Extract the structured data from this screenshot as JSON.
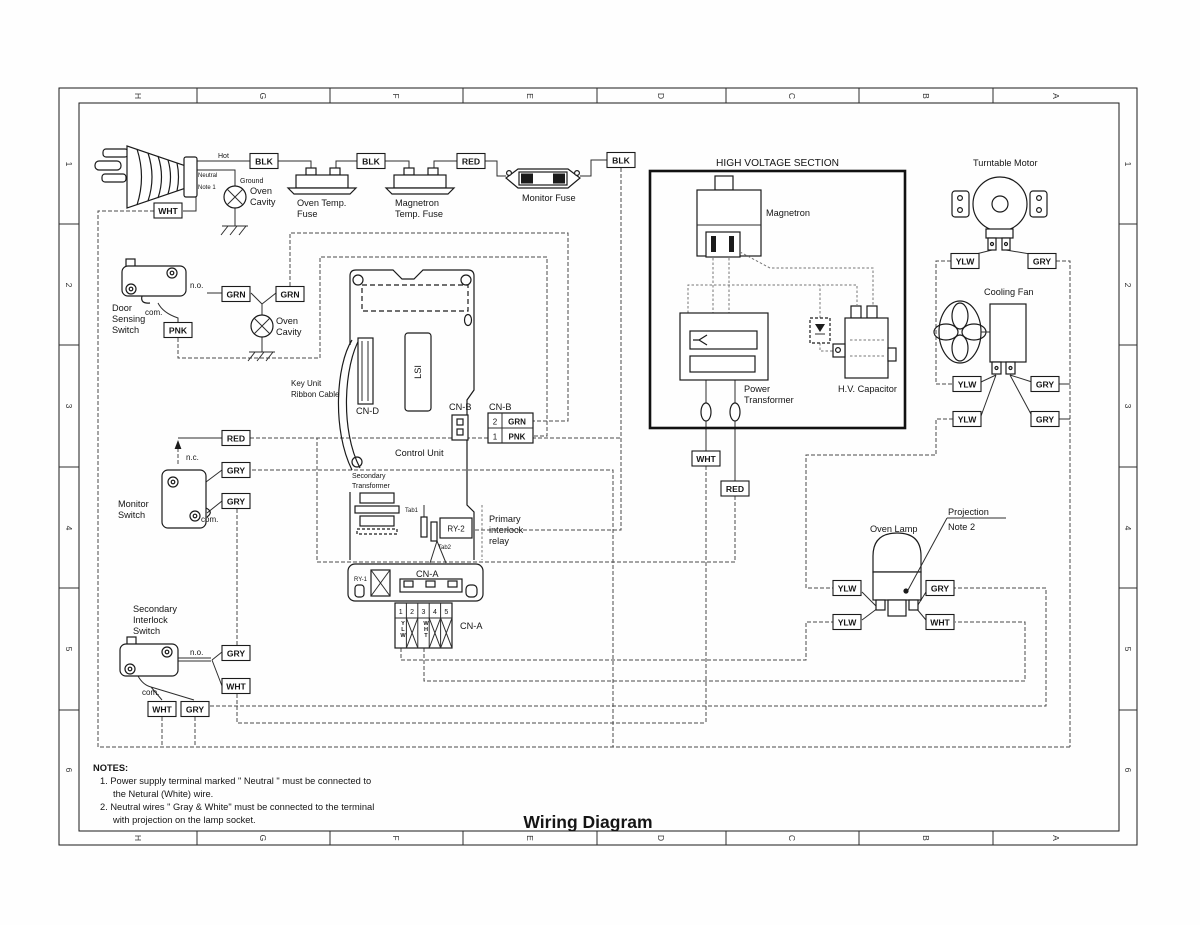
{
  "title": "Wiring Diagram",
  "grid": {
    "cols": [
      "H",
      "G",
      "F",
      "E",
      "D",
      "C",
      "B",
      "A"
    ],
    "rows": [
      "1",
      "2",
      "3",
      "4",
      "5",
      "6"
    ]
  },
  "plug": {
    "hot": "Hot",
    "neutral": "Neutral",
    "note1": "Note 1",
    "ground": "Ground"
  },
  "labels": {
    "oven_cavity_1": "Oven",
    "oven_cavity_2": "Cavity",
    "oven_temp_fuse_1": "Oven Temp.",
    "oven_temp_fuse_2": "Fuse",
    "mag_temp_fuse_1": "Magnetron",
    "mag_temp_fuse_2": "Temp. Fuse",
    "monitor_fuse": "Monitor Fuse",
    "door_switch_1": "Door",
    "door_switch_2": "Sensing",
    "door_switch_3": "Switch",
    "monitor_switch_1": "Monitor",
    "monitor_switch_2": "Switch",
    "sec_interlock_1": "Secondary",
    "sec_interlock_2": "Interlock",
    "sec_interlock_3": "Switch",
    "no": "n.o.",
    "nc": "n.c.",
    "com": "com.",
    "key_unit_1": "Key Unit",
    "key_unit_2": "Ribbon Cable",
    "cn_d": "CN-D",
    "lsi": "LSI",
    "cn_b": "CN-B",
    "cn_a": "CN-A",
    "control_unit": "Control Unit",
    "sec_transformer_1": "Secondary",
    "sec_transformer_2": "Transformer",
    "tab1": "Tab1",
    "ry2": "RY-2",
    "tab2": "Tab2",
    "ry1": "RY-1",
    "relay_1": "Primary",
    "relay_2": "interlock",
    "relay_3": "relay",
    "hv_section": "HIGH VOLTAGE SECTION",
    "magnetron": "Magnetron",
    "pwr_transformer_1": "Power",
    "pwr_transformer_2": "Transformer",
    "hv_capacitor": "H.V. Capacitor",
    "turntable_motor": "Turntable Motor",
    "cooling_fan": "Cooling Fan",
    "oven_lamp": "Oven Lamp",
    "projection": "Projection",
    "note2": "Note 2"
  },
  "cn_b_table": {
    "rows": [
      {
        "pin": "2",
        "color": "GRN"
      },
      {
        "pin": "1",
        "color": "PNK"
      }
    ]
  },
  "cn_a_table": {
    "pins": [
      "1",
      "2",
      "3",
      "4",
      "5"
    ],
    "pin1_color": "YLW",
    "pin3_color": "WHT"
  },
  "wire_labels": [
    "BLK",
    "BLK",
    "RED",
    "BLK",
    "WHT",
    "GRN",
    "GRN",
    "PNK",
    "RED",
    "GRY",
    "GRY",
    "GRY",
    "WHT",
    "WHT",
    "GRY",
    "WHT",
    "RED",
    "YLW",
    "GRY",
    "YLW",
    "GRY",
    "YLW",
    "GRY",
    "YLW",
    "GRY",
    "YLW",
    "WHT"
  ],
  "notes": {
    "heading": "NOTES:",
    "lines": [
      "1.  Power supply terminal marked \" Neutral \" must be connected to",
      "the Netural (White) wire.",
      "2.  Neutral wires \" Gray & White\" must be connected to the terminal",
      "with projection on the lamp socket."
    ]
  }
}
